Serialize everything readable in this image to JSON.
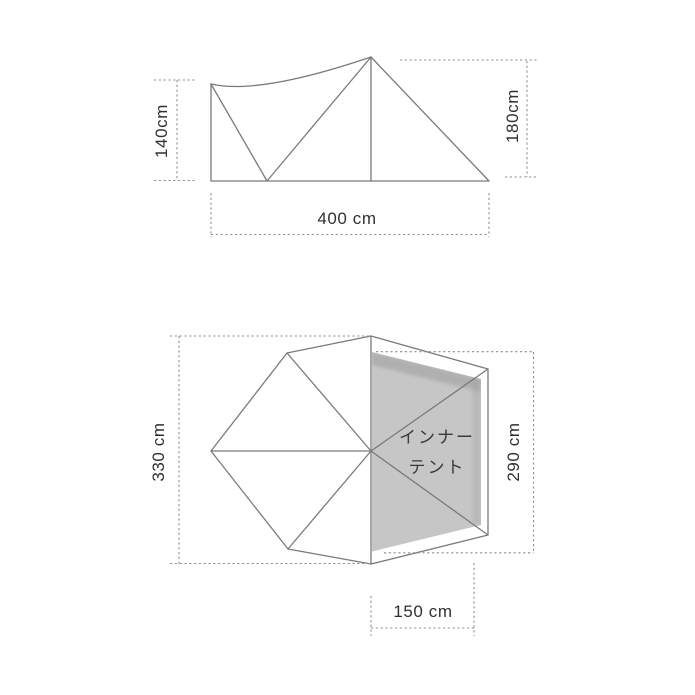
{
  "colors": {
    "outline": "#7a7a7a",
    "dashed": "#8f8f8f",
    "label_text": "#303030",
    "inner_tent_fill": "#c6c6c6",
    "inner_tent_shade": "#9c9c9c",
    "inner_tent_text": "#3a3a3a",
    "background": "#ffffff"
  },
  "elevation_view": {
    "left_height_label": "140cm",
    "right_height_label": "180cm",
    "width_label": "400 cm"
  },
  "plan_view": {
    "outer_depth_label": "330 cm",
    "inner_depth_label": "290 cm",
    "inner_width_label": "150 cm",
    "inner_tent_line1": "インナー",
    "inner_tent_line2": "テント"
  }
}
